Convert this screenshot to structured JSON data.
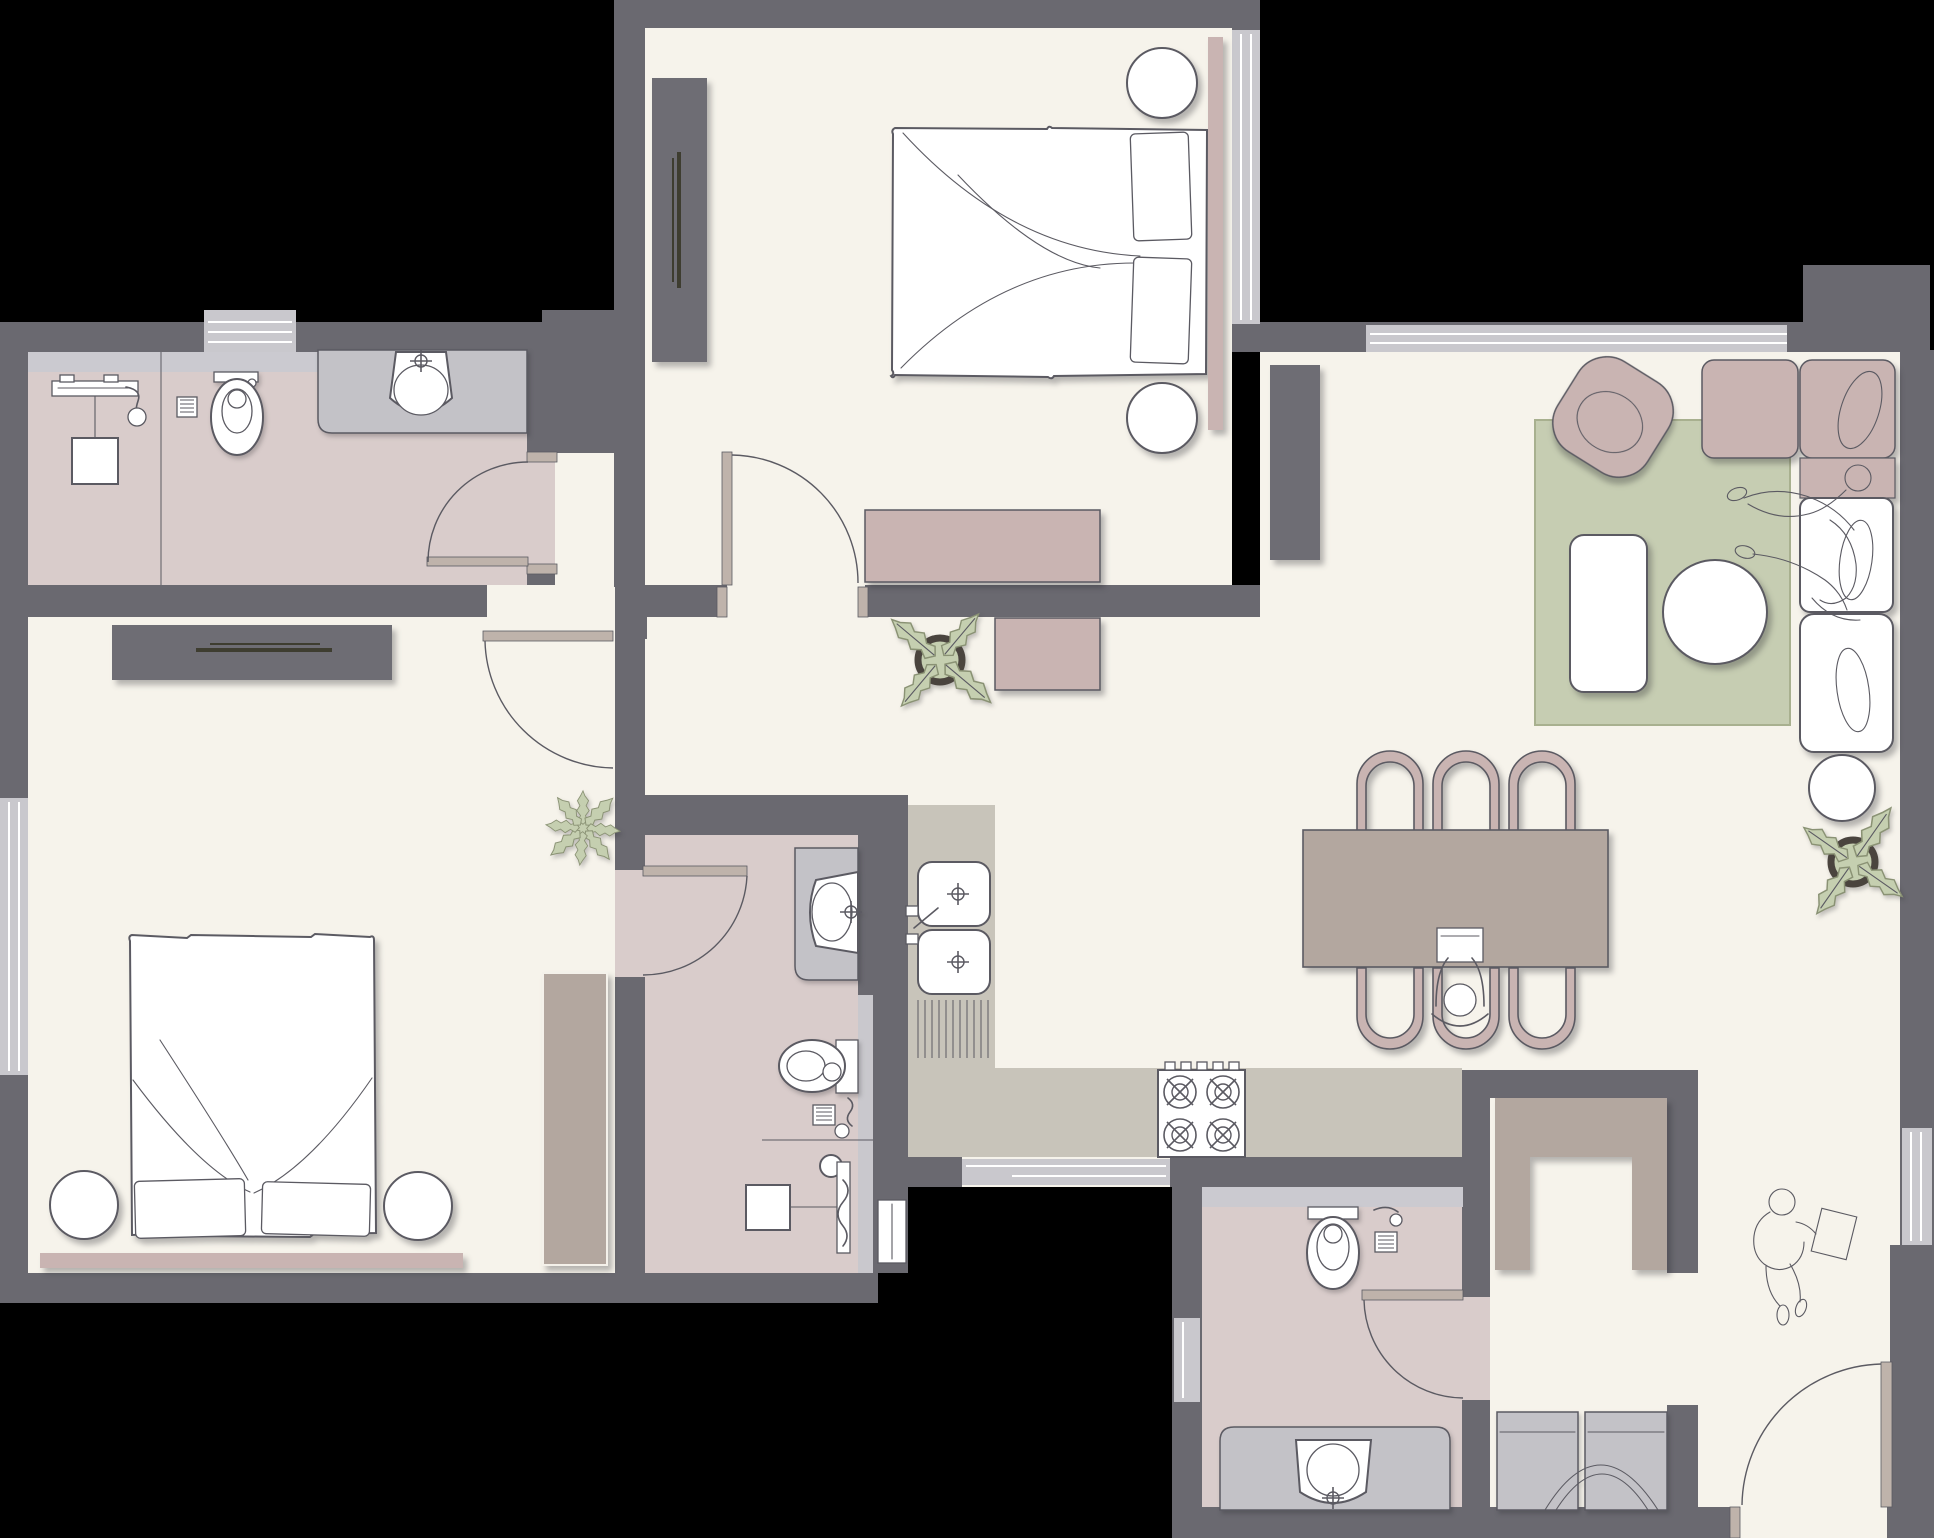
{
  "document": {
    "kind": "apartment-floor-plan",
    "visible_text": [],
    "canvas": {
      "width_px": 1934,
      "height_px": 1538
    }
  },
  "palette": {
    "bg": "#000000",
    "wall": "#6A6970",
    "floor": "#F6F3EB",
    "bathfloor": "#D9CCCB",
    "window": "#C9C8CD",
    "ledge": "#CBCAD0",
    "vanity": "#C3C2C7",
    "counter": "#C8C4BA",
    "mauve": "#C9B4B2",
    "greige": "#B3A79F",
    "rug": "#C6CDB2",
    "rugline": "#A8B08F",
    "leaf": "#C5CFB0",
    "leafline": "#8A9274",
    "pot": "#4A443E",
    "doorleaf": "#BFB3AB",
    "line": "#5B5A62",
    "darkfurn": "#6E6D74",
    "accentdark": "#3E3D30"
  },
  "rooms": [
    {
      "name": "ensuite-bathroom-top-left",
      "floor": "bathfloor",
      "fixtures": [
        "walk-in-shower",
        "floor-drain",
        "toilet",
        "vanity-sink",
        "window"
      ]
    },
    {
      "name": "master-bedroom",
      "floor": "floor",
      "fixtures": [
        "double-bed",
        "pillows",
        "round-poufs",
        "headboard",
        "wardrobe",
        "sideboard",
        "window",
        "door"
      ]
    },
    {
      "name": "bedroom-2",
      "floor": "floor",
      "fixtures": [
        "double-bed",
        "pillows",
        "round-poufs",
        "bed-bench",
        "tv-console",
        "tall-wardrobe",
        "window",
        "door"
      ]
    },
    {
      "name": "ensuite-bathroom-middle",
      "floor": "bathfloor",
      "fixtures": [
        "vanity-sink",
        "wall-hung-toilet",
        "floor-drain",
        "shower",
        "glass-screen",
        "door"
      ]
    },
    {
      "name": "kitchen",
      "floor": "floor",
      "fixtures": [
        "double-basin-sink",
        "drainboard",
        "l-shaped-counter",
        "cooktop-4-burners",
        "window"
      ]
    },
    {
      "name": "dining-area",
      "floor": "floor",
      "fixtures": [
        "dining-table",
        "six-chairs",
        "seated-person-with-laptop",
        "hall-console"
      ]
    },
    {
      "name": "living-room",
      "floor": "floor",
      "fixtures": [
        "area-rug",
        "corner-sofa",
        "lounging-people-sketch",
        "armchair",
        "coffee-table",
        "round-table",
        "side-table",
        "tall-cabinet",
        "potted-plant",
        "windows"
      ]
    },
    {
      "name": "entry-hall",
      "floor": "floor",
      "fixtures": [
        "entry-door",
        "walking-person-sketch",
        "closet-nook",
        "storage-benches",
        "window"
      ]
    },
    {
      "name": "bathroom-3",
      "floor": "bathfloor",
      "fixtures": [
        "toilet",
        "shower-corner",
        "floor-drain",
        "vanity-sink",
        "window",
        "door"
      ]
    },
    {
      "name": "plants",
      "count": 3
    }
  ]
}
